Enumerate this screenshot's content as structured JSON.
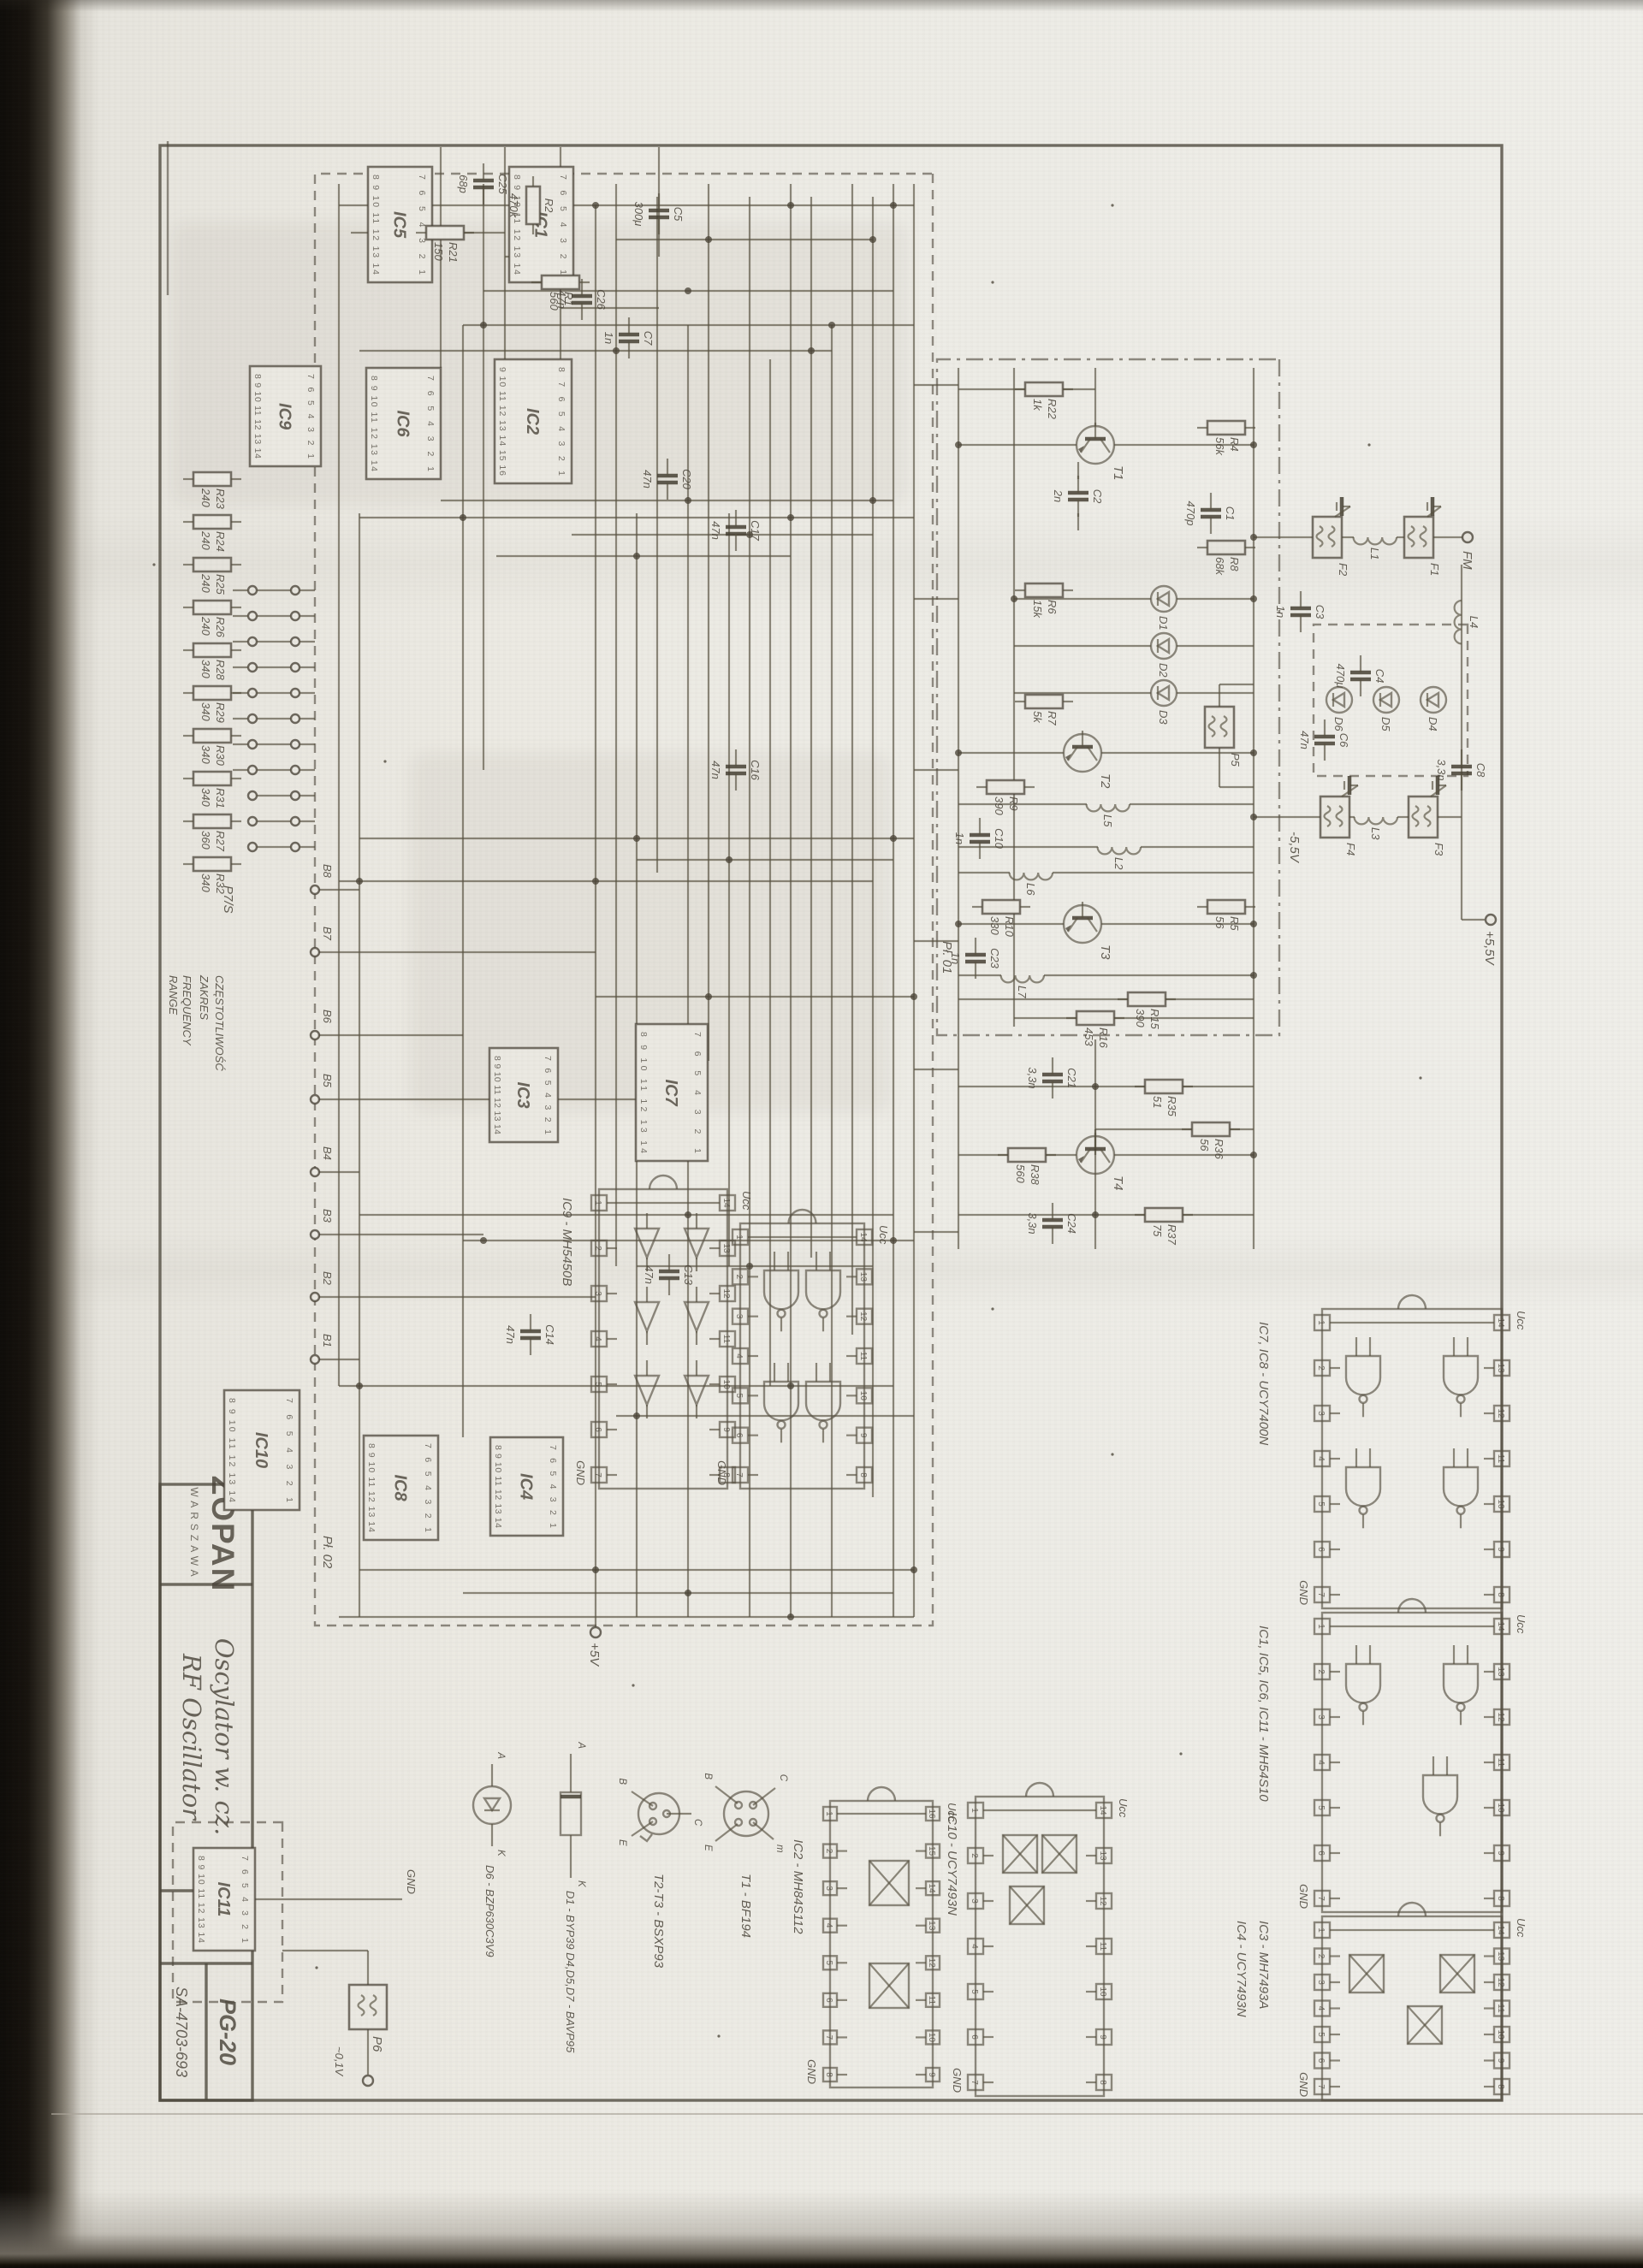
{
  "page": {
    "paper": "#eae8e1",
    "ink": "#4d483e",
    "ink_soft": "#6e6759",
    "gutter": "#16120d"
  },
  "title_block": {
    "company": "ZOPAN",
    "city": "WARSZAWA",
    "title_pl": "Oscylator w. cz.",
    "title_en": "RF Oscillator",
    "model": "PG-20",
    "doc_number": "SA-4703-693"
  },
  "board_labels": {
    "board1": "Pł. 01",
    "board2": "Pł. 02"
  },
  "connectors": {
    "main": "P7/S",
    "aux": "P6",
    "aux_level": "~0,1V",
    "output": "FM",
    "range_pl_1": "CZĘSTOTLIWOŚĆ",
    "range_pl_2": "ZAKRES",
    "range_en_1": "FREQUENCY",
    "range_en_2": "RANGE"
  },
  "power": {
    "p5": "+5V",
    "p55": "+5,5V",
    "m55": "-5,5V",
    "vcc": "Ucc",
    "gnd": "GND"
  },
  "misc": {
    "m8": "M8"
  },
  "bus_labels": [
    "B8",
    "B7",
    "B6",
    "B5",
    "B4",
    "B3",
    "B2",
    "B1"
  ],
  "main_ics": [
    "IC1",
    "IC2",
    "IC3",
    "IC4",
    "IC5",
    "IC6",
    "IC7",
    "IC8",
    "IC9",
    "IC10",
    "IC11"
  ],
  "pin_numbers": {
    "dip14_main_top": "7 6 5 4 3 2 1",
    "dip14_main_bottom": "8 9 10 11 12 13 14",
    "dip16_main_top": "8 7 6 5 4 3 2 1",
    "dip16_main_bottom": "9 10 11 12 13 14 15 16",
    "dip14_top": [
      14,
      13,
      12,
      11,
      10,
      9,
      8
    ],
    "dip14_bottom": [
      1,
      2,
      3,
      4,
      5,
      6,
      7
    ],
    "dip16_top": [
      16,
      15,
      14,
      13,
      12,
      11,
      10,
      9
    ],
    "dip16_bottom": [
      1,
      2,
      3,
      4,
      5,
      6,
      7,
      8
    ]
  },
  "pinouts": [
    {
      "label": "IC7, IC8 - UCY7400N"
    },
    {
      "label": "IC1, IC5, IC6, IC11 - MH54S10"
    },
    {
      "label": "IC3 - MH7493A",
      "label2": "IC4 - UCY7493N"
    },
    {
      "label": ""
    },
    {
      "label": "IC9 - MH5450B"
    },
    {
      "label": "IC10 - UCY7493N"
    },
    {
      "label": "IC2 - MH84S112"
    }
  ],
  "packages": [
    {
      "label": "T1 - BF194",
      "leads": [
        "C",
        "B",
        "E",
        "m"
      ]
    },
    {
      "label": "T2-T3 - BSXP93",
      "leads": [
        "C",
        "B",
        "E"
      ]
    },
    {
      "label": "D1 - BYP39   D4,D5,D7 - BAVP95",
      "leads": [
        "K",
        "A"
      ]
    },
    {
      "label": "D6 - BZP630C3V9",
      "leads": [
        "K",
        "A"
      ]
    }
  ],
  "resistors": [
    {
      "ref": "R2",
      "value": "470k"
    },
    {
      "ref": "R1",
      "value": "560"
    },
    {
      "ref": "R21",
      "value": "150"
    },
    {
      "ref": "R4",
      "value": "56k"
    },
    {
      "ref": "R8",
      "value": "68k"
    },
    {
      "ref": "R5",
      "value": "56"
    },
    {
      "ref": "R22",
      "value": "1k"
    },
    {
      "ref": "R6",
      "value": "15k"
    },
    {
      "ref": "R7",
      "value": "5k"
    },
    {
      "ref": "R9",
      "value": "390"
    },
    {
      "ref": "R10",
      "value": "330"
    },
    {
      "ref": "R15",
      "value": "390"
    },
    {
      "ref": "R16",
      "value": "453"
    },
    {
      "ref": "R35",
      "value": "51"
    },
    {
      "ref": "R36",
      "value": "56"
    },
    {
      "ref": "R37",
      "value": "75"
    },
    {
      "ref": "R38",
      "value": "560"
    },
    {
      "ref": "R23",
      "value": "240"
    },
    {
      "ref": "R24",
      "value": "240"
    },
    {
      "ref": "R25",
      "value": "240"
    },
    {
      "ref": "R26",
      "value": "240"
    },
    {
      "ref": "R28",
      "value": "340"
    },
    {
      "ref": "R29",
      "value": "340"
    },
    {
      "ref": "R30",
      "value": "340"
    },
    {
      "ref": "R31",
      "value": "340"
    },
    {
      "ref": "R27",
      "value": "360"
    },
    {
      "ref": "R32",
      "value": "340"
    }
  ],
  "capacitors": [
    {
      "ref": "C25",
      "value": "68p"
    },
    {
      "ref": "C26",
      "value": "47n"
    },
    {
      "ref": "C7",
      "value": "1n"
    },
    {
      "ref": "C5",
      "value": "300μ"
    },
    {
      "ref": "C1",
      "value": "470p"
    },
    {
      "ref": "C2",
      "value": "2n"
    },
    {
      "ref": "C3",
      "value": "1n"
    },
    {
      "ref": "C4",
      "value": "470μ"
    },
    {
      "ref": "C6",
      "value": "47n"
    },
    {
      "ref": "C8",
      "value": "3,3n"
    },
    {
      "ref": "C10",
      "value": "1n"
    },
    {
      "ref": "C23",
      "value": "1n"
    },
    {
      "ref": "C21",
      "value": "3,3n"
    },
    {
      "ref": "C24",
      "value": "3,3n"
    },
    {
      "ref": "C20",
      "value": "47n"
    },
    {
      "ref": "C17",
      "value": "47n"
    },
    {
      "ref": "C16",
      "value": "47n"
    },
    {
      "ref": "C13",
      "value": "47n"
    },
    {
      "ref": "C14",
      "value": "47n"
    }
  ],
  "transistors": [
    "T1",
    "T2",
    "T3",
    "T4"
  ],
  "diodes": [
    "D1",
    "D2",
    "D3",
    "D4",
    "D5",
    "D6"
  ],
  "coils": [
    "L1",
    "L2",
    "L3",
    "L4",
    "L5",
    "L6",
    "L7"
  ],
  "filters": [
    "F1",
    "F2",
    "F3",
    "F4",
    "P5"
  ]
}
